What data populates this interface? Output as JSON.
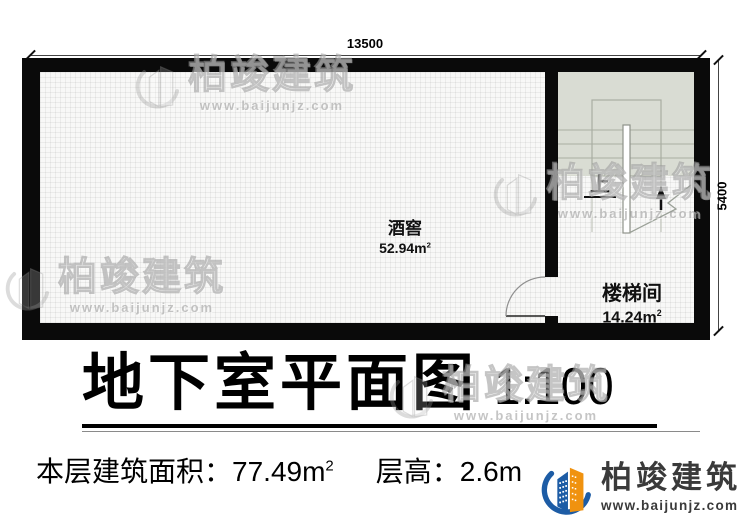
{
  "plan": {
    "dimensions": {
      "top": "13500",
      "right": "5400"
    },
    "rooms": [
      {
        "name": "酒窖",
        "area": "52.94",
        "unit": "m",
        "sup": "2"
      },
      {
        "name": "楼梯间",
        "area": "14.24",
        "unit": "m",
        "sup": "2"
      }
    ],
    "stair": {
      "up_label": "上"
    }
  },
  "title": {
    "text": "地下室平面图",
    "scale": "1:100"
  },
  "info": {
    "area_label": "本层建筑面积：",
    "area_value": "77.49",
    "area_unit": "m",
    "area_sup": "2",
    "height_label": "层高：",
    "height_value": "2.6m"
  },
  "brand": {
    "name": "柏竣建筑",
    "url": "www.baijunjz.com"
  },
  "watermark": {
    "name": "柏竣建筑",
    "url": "www.baijunjz.com"
  },
  "colors": {
    "wall": "#0a0a0a",
    "stair_fill": "#d9dcd3",
    "logo_blue": "#1d5ca5",
    "logo_orange": "#f0920f",
    "logo_text": "#3a3a3a"
  }
}
